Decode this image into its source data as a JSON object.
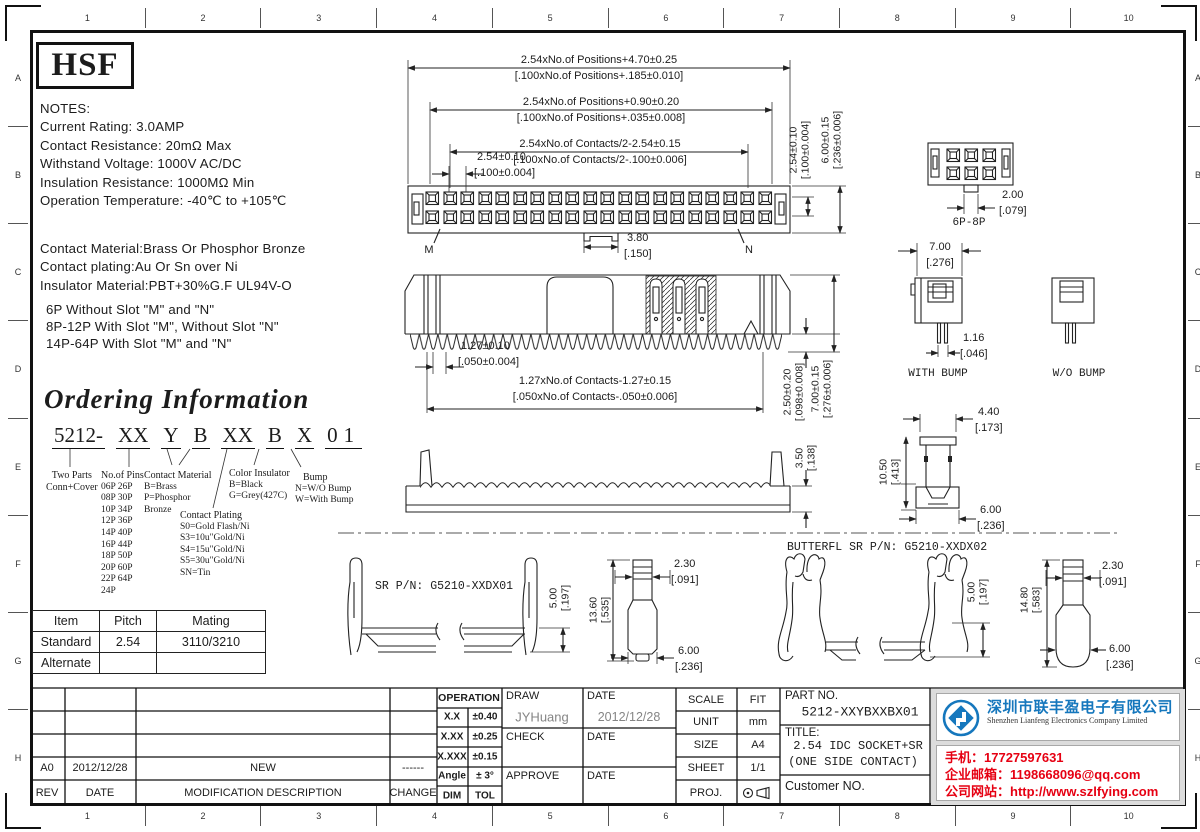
{
  "sheet": {
    "cols": [
      "1",
      "2",
      "3",
      "4",
      "5",
      "6",
      "7",
      "8",
      "9",
      "10"
    ],
    "rows": [
      "A",
      "B",
      "C",
      "D",
      "E",
      "F",
      "G",
      "H"
    ]
  },
  "logo_text": "HSF",
  "notes": {
    "l0": "NOTES:",
    "l1": "Current Rating: 3.0AMP",
    "l2": "Contact Resistance: 20mΩ Max",
    "l3": "Withstand Voltage: 1000V AC/DC",
    "l4": "Insulation Resistance: 1000MΩ Min",
    "l5": "Operation Temperature: -40℃ to +105℃",
    "m0": "Contact Material:Brass Or Phosphor Bronze",
    "m1": "Contact plating:Au Or Sn over Ni",
    "m2": "Insulator Material:PBT+30%G.F UL94V-O",
    "s0": "6P Without Slot \"M\" and \"N\"",
    "s1": "8P-12P With Slot \"M\", Without Slot \"N\"",
    "s2": "14P-64P With Slot \"M\" and \"N\""
  },
  "ordering": {
    "title": "Ordering Information",
    "code": [
      "5212-",
      "XX",
      "Y",
      "B",
      "XX",
      "B",
      "X",
      "01"
    ],
    "two_parts": [
      "Two Parts",
      "Conn+Cover"
    ],
    "pins_header": "No.of Pins",
    "pins": [
      "06P 26P",
      "08P 30P",
      "10P 34P",
      "12P 36P",
      "14P 40P",
      "16P 44P",
      "18P 50P",
      "20P 60P",
      "22P 64P",
      "24P"
    ],
    "cmat_header": "Contact Material",
    "cmat": [
      "B=Brass",
      "P=Phosphor",
      "Bronze"
    ],
    "cplate_header": "Contact Plating",
    "cplate": [
      "S0=Gold Flash/Ni",
      "S3=10u\"Gold/Ni",
      "S4=15u\"Gold/Ni",
      "S5=30u\"Gold/Ni",
      "SN=Tin"
    ],
    "cins_header": "Color Insulator",
    "cins": [
      "B=Black",
      "G=Grey(427C)"
    ],
    "bump_header": "Bump",
    "bump": [
      "N=W/O Bump",
      "W=With Bump"
    ]
  },
  "pitch_table": {
    "headers": [
      "Item",
      "Pitch",
      "Mating"
    ],
    "rows": [
      [
        "Standard",
        "2.54",
        "3110/3210"
      ],
      [
        "Alternate",
        "",
        ""
      ]
    ]
  },
  "dims": {
    "pos1": "2.54xNo.of Positions+4.70±0.25",
    "pos1b": "[.100xNo.of Positions+.185±0.010]",
    "pos2": "2.54xNo.of Positions+0.90±0.20",
    "pos2b": "[.100xNo.of Positions+.035±0.008]",
    "con1": "2.54xNo.of Contacts/2-2.54±0.15",
    "con1b": "[.100xNo.of Contacts/2-.100±0.006]",
    "p254": "2.54±0.10",
    "p254b": "[.100±0.004]",
    "h600": "6.00±0.15",
    "h600b": "[.236±0.006]",
    "m": "M",
    "n": "N",
    "tab380": "3.80",
    "tab380b": "[.150]",
    "c127": "1.27±0.10",
    "c127b": "[.050±0.004]",
    "cspan": "1.27xNo.of Contacts-1.27±0.15",
    "cspanb": "[.050xNo.of Contacts-.050±0.006]",
    "d250": "2.50±0.20",
    "d250b": "[.098±0.008]",
    "d700": "7.00±0.15",
    "d700b": "[.276±0.006]",
    "sr350": "3.50",
    "sr350b": "[.138]"
  },
  "views": {
    "sr_label": "SR P/N: G5210-XXDX01",
    "bf_label": "BUTTERFL SR P/N: G5210-XXDX02",
    "conn68": "6P-8P",
    "with_bump": "WITH BUMP",
    "wo_bump": "W/O BUMP",
    "d200": "2.00",
    "d200b": "[.079]",
    "d700": "7.00",
    "d700b": "[.276]",
    "d116": "1.16",
    "d116b": "[.046]",
    "d500": "5.00",
    "d500b": "[.197]",
    "d1360": "13.60",
    "d1360b": "[.535]",
    "d230": "2.30",
    "d230b": "[.091]",
    "d600": "6.00",
    "d600b": "[.236]",
    "d1480": "14.80",
    "d1480b": "[.583]",
    "d440": "4.40",
    "d440b": "[.173]",
    "d1050": "10.50",
    "d1050b": "[.413]"
  },
  "titleblock": {
    "rev_headers": [
      "REV",
      "DATE",
      "MODIFICATION DESCRIPTION",
      "CHANGE"
    ],
    "rev_row": [
      "A0",
      "2012/12/28",
      "NEW",
      "------"
    ],
    "operation": "OPERATION",
    "tol": [
      [
        "X.X",
        "±0.40"
      ],
      [
        "X.XX",
        "±0.25"
      ],
      [
        "X.XXX",
        "±0.15"
      ],
      [
        "Angle",
        "± 3°"
      ],
      [
        "DIM",
        "TOL"
      ]
    ],
    "draw": "DRAW",
    "draw_name": "JYHuang",
    "date": "DATE",
    "draw_date": "2012/12/28",
    "check": "CHECK",
    "approve": "APPROVE",
    "scale": "SCALE",
    "scale_v": "FIT",
    "unit": "UNIT",
    "unit_v": "mm",
    "size": "SIZE",
    "size_v": "A4",
    "sheet": "SHEET",
    "sheet_v": "1/1",
    "proj": "PROJ.",
    "part_label": "PART NO.",
    "part_value": "5212-XXYBXXBX01",
    "title_label": "TITLE:",
    "title_1": "2.54 IDC SOCKET+SR",
    "title_2": "(ONE SIDE CONTACT)",
    "customer": "Customer NO."
  },
  "company": {
    "name_cn": "深圳市联丰盈电子有限公司",
    "name_en": "Shenzhen Lianfeng Electronics Company Limited",
    "phone": "手机：17727597631",
    "email": "企业邮箱：1198668096@qq.com",
    "website": "公司网站：http://www.szlfying.com",
    "blue": "#1577bd",
    "red": "#e60012"
  }
}
